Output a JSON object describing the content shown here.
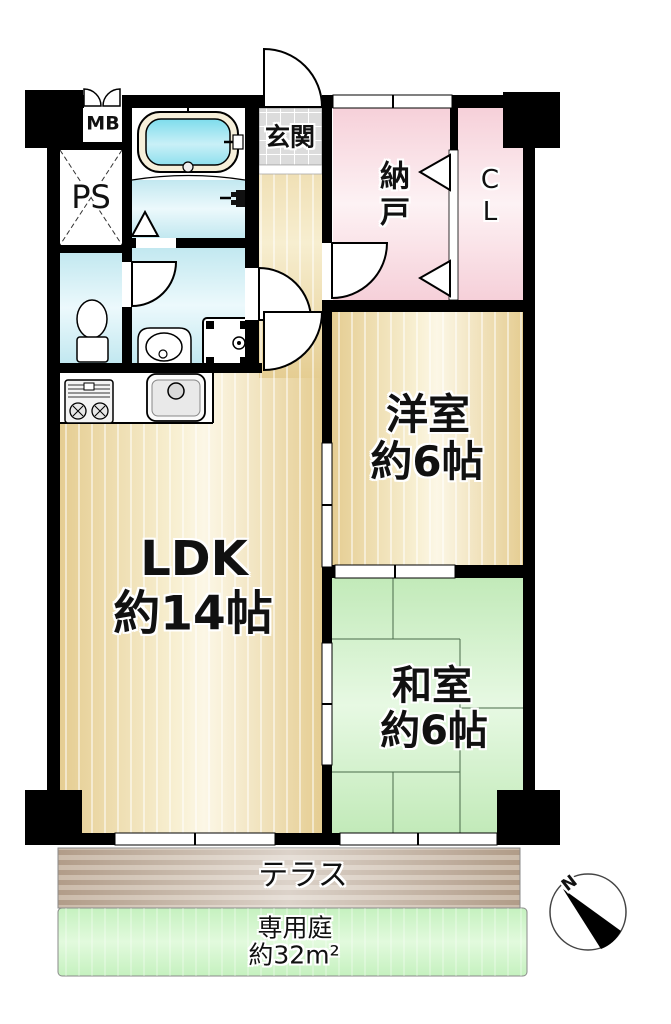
{
  "floorplan": {
    "rooms": {
      "ldk": {
        "name_label": "LDK",
        "size_label": "約14帖"
      },
      "western_room": {
        "name_label": "洋室",
        "size_label": "約6帖"
      },
      "japanese_room": {
        "name_label": "和室",
        "size_label": "約6帖"
      },
      "storage_room": {
        "label": "納戸"
      },
      "closet": {
        "label": "CL"
      },
      "entrance": {
        "label": "玄関"
      },
      "pipe_space": {
        "label": "PS"
      },
      "meter_box": {
        "label": "MB"
      },
      "terrace": {
        "label": "テラス"
      },
      "private_garden": {
        "name_label": "専用庭",
        "size_label": "約32m²"
      }
    },
    "compass": {
      "north_label": "N"
    },
    "colors": {
      "wall": "#000000",
      "wood_floor": "#e8d199",
      "storage_pink": "#f7d5dc",
      "tatami_green": "#c9ecc1",
      "wet_area_cyan": "#c6eaf2",
      "terrace_brown": "#b3a08c",
      "garden_green": "#c8f2c2",
      "entrance_tile": "#dcdcdc",
      "bath_water": "#83dcec"
    }
  }
}
